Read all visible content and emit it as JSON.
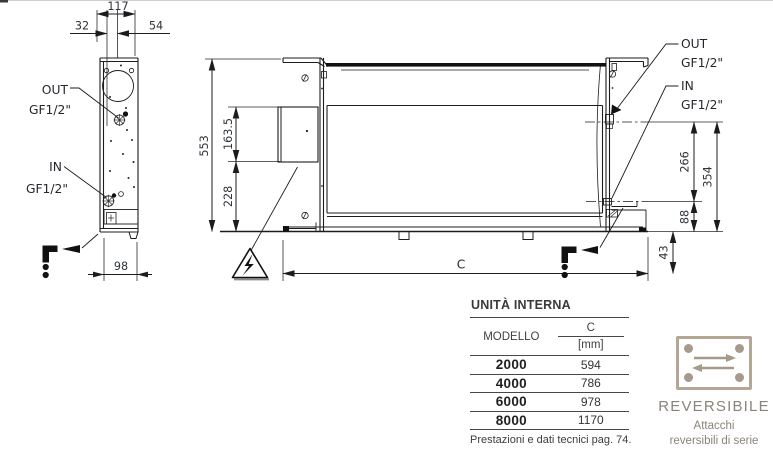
{
  "drawing": {
    "side_view": {
      "dim_depth": "117",
      "dim_front_offset": "32",
      "dim_back_offset": "54",
      "dim_base_depth": "98",
      "label_out": "OUT",
      "label_pipe_out": "GF1/2\"",
      "label_in": "IN",
      "label_pipe_in": "GF1/2\""
    },
    "front_view": {
      "dim_height": "553",
      "dim_box_height": "163.5",
      "dim_box_bottom": "228",
      "dim_length": "C",
      "dim_out_in_gap": "266",
      "dim_out_height": "354",
      "dim_in_height": "88",
      "dim_drain_height": "43",
      "label_out": "OUT",
      "label_pipe_out": "GF1/2\"",
      "label_in": "IN",
      "label_pipe_in": "GF1/2\""
    }
  },
  "table": {
    "title": "UNITÀ INTERNA",
    "col_model": "MODELLO",
    "col_c": "C",
    "col_unit": "[mm]",
    "rows": [
      {
        "model": "2000",
        "c": "594"
      },
      {
        "model": "4000",
        "c": "786"
      },
      {
        "model": "6000",
        "c": "978"
      },
      {
        "model": "8000",
        "c": "1170"
      }
    ],
    "footer": "Prestazioni e dati tecnici pag. 74."
  },
  "badge": {
    "title": "REVERSIBILE",
    "line1": "Attacchi",
    "line2": "reversibili di serie"
  },
  "colors": {
    "line": "#1c1c1c",
    "badge_accent": "#b5a795",
    "badge_text": "#8a8379"
  }
}
